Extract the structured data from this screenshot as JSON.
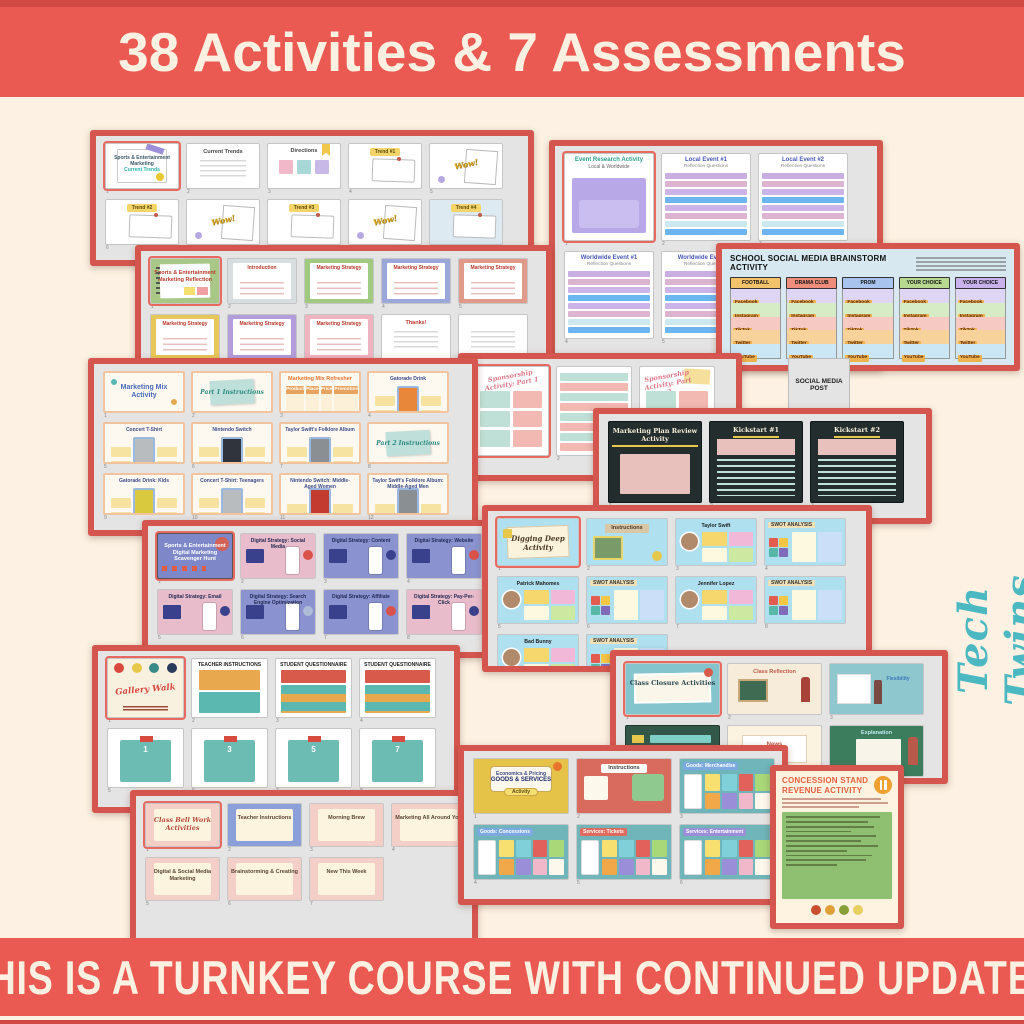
{
  "top_banner": {
    "text": "38 Activities & 7 Assessments",
    "bg": "#ea5a52",
    "fg": "#fbf0e1"
  },
  "bottom_banner": {
    "text": "THIS IS A TURNKEY COURSE WITH CONTINUED UPDATES",
    "bg": "#ea5a52",
    "fg": "#fbf0e1"
  },
  "watermark": {
    "text": "Tech Twins",
    "color": "#4bb8c2"
  },
  "social_media_post_label": "SOCIAL MEDIA POST",
  "colors": {
    "background": "#fcf1e2",
    "panel_border": "#d5564e",
    "panel_bg": "#e4e4e4",
    "banner_edge": "#d04a43"
  },
  "panels": [
    {
      "id": "current-trends",
      "type": "slides",
      "slides": [
        {
          "n": "Sports & Entertainment Marketing",
          "sub": "Current Trends",
          "style": "titlenote",
          "sel": true,
          "chips": [
            "#e8c830"
          ]
        },
        {
          "n": "Current Trends",
          "style": "doc"
        },
        {
          "n": "Directions",
          "style": "stickies",
          "chips": [
            "#f0b8c8",
            "#a8d8d8",
            "#c8b8e8"
          ]
        },
        {
          "n": "Trend #1",
          "style": "trend"
        },
        {
          "n": "Wow!",
          "style": "wow"
        },
        {
          "n": "Trend #2",
          "style": "trend"
        },
        {
          "n": "Wow!",
          "style": "wow"
        },
        {
          "n": "Trend #3",
          "style": "trend"
        },
        {
          "n": "Wow!",
          "style": "wow"
        },
        {
          "n": "Trend #4",
          "style": "trend",
          "bg": "#ddeaf2"
        }
      ]
    },
    {
      "id": "marketing-reflection",
      "type": "slides",
      "slides": [
        {
          "n": "Sports & Entertainment Marketing Reflection",
          "style": "greencover",
          "sel": true,
          "chips": [
            "#f5df70",
            "#f0a0a0"
          ]
        },
        {
          "n": "Introduction",
          "style": "notebook",
          "accent": "#d8dde0"
        },
        {
          "n": "Marketing Strategy",
          "style": "notebook",
          "accent": "#9fca7f"
        },
        {
          "n": "Marketing Strategy",
          "style": "notebook",
          "accent": "#9aa7d8"
        },
        {
          "n": "Marketing Strategy",
          "style": "notebook",
          "accent": "#e09a8a"
        },
        {
          "n": "Marketing Strategy",
          "style": "notebook",
          "accent": "#e8c75a"
        },
        {
          "n": "Marketing Strategy",
          "style": "notebook",
          "accent": "#b39ddb"
        },
        {
          "n": "Marketing Strategy",
          "style": "notebook",
          "accent": "#f0b3c0"
        },
        {
          "n": "Thanks!",
          "style": "doc",
          "lc": "#c0392b",
          "chips": []
        },
        {
          "n": "",
          "style": "doc",
          "chips": []
        }
      ]
    },
    {
      "id": "event-research",
      "type": "slides",
      "slides": [
        {
          "n": "Event Research Activity",
          "sub": "Local & Worldwide",
          "style": "eventcover",
          "sel": true
        },
        {
          "n": "Local Event #1",
          "sub": "Reflection Questions",
          "style": "qsheet",
          "bars": [
            "#c9aee2",
            "#dcb4cf",
            "#cbb4e8",
            "#6db5f0",
            "#cbb4e8",
            "#dcb4cf",
            "#cde9f0",
            "#6db5f0"
          ]
        },
        {
          "n": "Local Event #2",
          "sub": "Reflection Questions",
          "style": "qsheet",
          "bars": [
            "#c9aee2",
            "#dcb4cf",
            "#cbb4e8",
            "#6db5f0",
            "#cbb4e8",
            "#dcb4cf",
            "#cde9f0",
            "#6db5f0"
          ]
        },
        {
          "n": "Worldwide Event #1",
          "sub": "Reflection Questions",
          "style": "qsheet",
          "bars": [
            "#c9aee2",
            "#dcb4cf",
            "#cbb4e8",
            "#6db5f0",
            "#cbb4e8",
            "#dcb4cf",
            "#cde9f0",
            "#6db5f0"
          ]
        },
        {
          "n": "Worldwide Event #2",
          "sub": "Reflection Questions",
          "style": "qsheet",
          "bars": [
            "#c9aee2",
            "#dcb4cf",
            "#cbb4e8",
            "#6db5f0",
            "#cbb4e8",
            "#dcb4cf",
            "#cde9f0",
            "#6db5f0"
          ]
        }
      ]
    },
    {
      "id": "social-media-brainstorm",
      "type": "brainstorm",
      "title": "SCHOOL SOCIAL MEDIA BRAINSTORM ACTIVITY",
      "columns": [
        {
          "label": "FOOTBALL",
          "color": "#f3c36b"
        },
        {
          "label": "DRAMA CLUB",
          "color": "#ee8d7c"
        },
        {
          "label": "PROM",
          "color": "#a9c3ef"
        },
        {
          "label": "YOUR CHOICE",
          "color": "#b6d88f"
        },
        {
          "label": "YOUR CHOICE",
          "color": "#c9b2ec"
        }
      ],
      "rows": [
        "Facebook",
        "Instagram",
        "TikTok",
        "Twitter",
        "YouTube"
      ],
      "row_colors": [
        "#ded6f4",
        "#d6ecc4",
        "#f6c9c2",
        "#f7d29a",
        "#cbe7f6"
      ],
      "chip_color": "#f0b24f"
    },
    {
      "id": "marketing-mix",
      "type": "slides",
      "slides": [
        {
          "n": "Marketing Mix Activity",
          "style": "mixcover"
        },
        {
          "n": "Part 1 Instructions",
          "style": "stickynote"
        },
        {
          "n": "Marketing Mix Refresher",
          "style": "refresher",
          "cols4": [
            "Product",
            "Place",
            "Price",
            "Promotion"
          ]
        },
        {
          "n": "Gatorade Drink",
          "style": "product",
          "accent": "#e8873a",
          "chips": [
            "#f7e3a1",
            "#f7e3a1",
            "#f7e3a1",
            "#f7e3a1"
          ]
        },
        {
          "n": "Concert T-Shirt",
          "style": "product",
          "accent": "#b9bcbe",
          "chips": [
            "#f7e3a1",
            "#f7e3a1",
            "#f7e3a1",
            "#f7e3a1"
          ]
        },
        {
          "n": "Nintendo Switch",
          "style": "product",
          "accent": "#30343c",
          "chips": [
            "#f7e3a1",
            "#f7e3a1",
            "#f7e3a1",
            "#f7e3a1"
          ]
        },
        {
          "n": "Taylor Swift's Folklore Album",
          "style": "product",
          "accent": "#8a8f94",
          "chips": [
            "#f7e3a1",
            "#f7e3a1",
            "#f7e3a1",
            "#f7e3a1"
          ]
        },
        {
          "n": "Part 2 Instructions",
          "style": "stickynote"
        },
        {
          "n": "Gatorade Drink: Kids",
          "style": "product",
          "accent": "#d8c93e",
          "chips": [
            "#f7e3a1",
            "#f7e3a1",
            "#f7e3a1",
            "#f7e3a1"
          ]
        },
        {
          "n": "Concert T-Shirt: Teenagers",
          "style": "product",
          "accent": "#b9bcbe",
          "chips": [
            "#f7e3a1",
            "#f7e3a1",
            "#f7e3a1",
            "#f7e3a1"
          ]
        },
        {
          "n": "Nintendo Switch: Middle-Aged Women",
          "style": "product",
          "accent": "#c23b2e",
          "chips": [
            "#f7e3a1",
            "#f7e3a1",
            "#f7e3a1",
            "#f7e3a1"
          ]
        },
        {
          "n": "Taylor Swift's Folklore Album: Middle-Aged Men",
          "style": "product",
          "accent": "#8a8f94",
          "chips": [
            "#f7e3a1",
            "#f7e3a1",
            "#f7e3a1",
            "#f7e3a1"
          ]
        }
      ]
    },
    {
      "id": "sponsorship",
      "type": "slides",
      "slides": [
        {
          "n": "Sponsorship Activity: Part 1",
          "style": "sponsor",
          "sel": true,
          "chips": [
            "#bfe0d6",
            "#f2b9b2",
            "#bfe0d6",
            "#f2b9b2",
            "#bfe0d6",
            "#f2b9b2"
          ]
        },
        {
          "n": "",
          "style": "companysheet",
          "bars": [
            "#bfe0d6",
            "#f2b9b2",
            "#bfe0d6",
            "#f2b9b2",
            "#bfe0d6",
            "#f2b9b2",
            "#bfe0d6",
            "#f2b9b2"
          ]
        },
        {
          "n": "Sponsorship Activity: Part 2",
          "style": "sponsor2",
          "chips": [
            "#bfe0d6",
            "#f2b9b2"
          ]
        }
      ]
    },
    {
      "id": "marketing-plan-review",
      "type": "slides",
      "slides": [
        {
          "n": "Marketing Plan Review Activity",
          "style": "chalk"
        },
        {
          "n": "Kickstart #1",
          "style": "chalkq"
        },
        {
          "n": "Kickstart #2",
          "style": "chalkq"
        }
      ]
    },
    {
      "id": "digital-scavenger-hunt",
      "type": "slides",
      "slides": [
        {
          "n": "Sports & Entertainment Digital Marketing Scavenger Hunt",
          "style": "scavcover",
          "bg": "#7e88c9",
          "sel": true
        },
        {
          "n": "Digital Strategy: Social Media",
          "style": "phone",
          "bg": "#e9bccb",
          "chips": [
            "#d9534a"
          ]
        },
        {
          "n": "Digital Strategy: Content",
          "style": "phone",
          "bg": "#8a93cf",
          "chips": [
            "#39418c"
          ]
        },
        {
          "n": "Digital Strategy: Website",
          "style": "phone",
          "bg": "#8a93cf",
          "chips": [
            "#d9534a"
          ]
        },
        {
          "n": "Digital Strategy: Email",
          "style": "phone",
          "bg": "#e9bccb",
          "chips": [
            "#39418c"
          ]
        },
        {
          "n": "Digital Strategy: Search Engine Optimization",
          "style": "phone",
          "bg": "#8a93cf",
          "chips": [
            "#aebcd8"
          ]
        },
        {
          "n": "Digital Strategy: Affiliate",
          "style": "phone",
          "bg": "#8a93cf",
          "chips": [
            "#d9534a"
          ]
        },
        {
          "n": "Digital Strategy: Pay-Per-Click",
          "style": "phone",
          "bg": "#e9bccb",
          "chips": [
            "#39418c"
          ]
        }
      ]
    },
    {
      "id": "digging-deep",
      "type": "slides",
      "slides": [
        {
          "n": "Digging Deep Activity",
          "style": "digcover",
          "bg": "#aee0f0",
          "sel": true
        },
        {
          "n": "Instructions",
          "style": "diginstr",
          "bg": "#aee0f0"
        },
        {
          "n": "Taylor Swift",
          "style": "person",
          "bg": "#aee0f0",
          "chips": [
            "#f5d76e",
            "#f2b8d8",
            "#fdf8e0",
            "#cde8a0"
          ]
        },
        {
          "n": "SWOT ANALYSIS",
          "style": "swot",
          "bg": "#aee0f0",
          "chips": [
            "#e45b4f",
            "#f5c544",
            "#58b8a8",
            "#7f6bb8"
          ]
        },
        {
          "n": "Patrick Mahomes",
          "style": "person",
          "bg": "#aee0f0",
          "chips": [
            "#f5d76e",
            "#f2b8d8",
            "#fdf8e0",
            "#cde8a0"
          ]
        },
        {
          "n": "SWOT ANALYSIS",
          "style": "swot",
          "bg": "#aee0f0",
          "chips": [
            "#e45b4f",
            "#f5c544",
            "#58b8a8",
            "#7f6bb8"
          ]
        },
        {
          "n": "Jennifer Lopez",
          "style": "person",
          "bg": "#aee0f0",
          "chips": [
            "#f5d76e",
            "#f2b8d8",
            "#fdf8e0",
            "#cde8a0"
          ]
        },
        {
          "n": "SWOT ANALYSIS",
          "style": "swot",
          "bg": "#aee0f0",
          "chips": [
            "#e45b4f",
            "#f5c544",
            "#58b8a8",
            "#7f6bb8"
          ]
        },
        {
          "n": "Bad Bunny",
          "style": "person",
          "bg": "#aee0f0",
          "chips": [
            "#f5d76e",
            "#f2b8d8",
            "#fdf8e0",
            "#cde8a0"
          ]
        },
        {
          "n": "SWOT ANALYSIS",
          "style": "swot",
          "bg": "#aee0f0",
          "chips": [
            "#e45b4f",
            "#f5c544",
            "#58b8a8",
            "#7f6bb8"
          ]
        }
      ]
    },
    {
      "id": "gallery-walk",
      "type": "slides",
      "slides": [
        {
          "n": "Gallery Walk",
          "style": "gallerycover",
          "sel": true,
          "chips": [
            "#d84a3f",
            "#e8c84a",
            "#3a8a8a",
            "#2a3a5a"
          ]
        },
        {
          "n": "TEACHER INSTRUCTIONS",
          "style": "gwteacher"
        },
        {
          "n": "STUDENT QUESTIONNAIRE",
          "style": "gwstudent"
        },
        {
          "n": "STUDENT QUESTIONNAIRE",
          "style": "gwstudent"
        },
        {
          "n": "1",
          "style": "gwcard",
          "accent": "#6cbcb4"
        },
        {
          "n": "3",
          "style": "gwcard",
          "accent": "#6cbcb4"
        },
        {
          "n": "5",
          "style": "gwcard",
          "accent": "#6cbcb4"
        },
        {
          "n": "7",
          "style": "gwcard",
          "accent": "#6cbcb4"
        }
      ]
    },
    {
      "id": "class-closure",
      "type": "slides",
      "slides": [
        {
          "n": "Class Closure Activities",
          "style": "closurecover",
          "sel": true
        },
        {
          "n": "Class Reflection",
          "style": "teachslide",
          "bg": "#f7ecd9"
        },
        {
          "n": "Flexibility",
          "style": "teachslide2",
          "bg": "#8fc7cf"
        },
        {
          "n": "",
          "style": "chalkgreen",
          "chips": [
            "#7fd0c8",
            "#7fd0c8",
            "#7fd0c8",
            "#7fd0c8"
          ]
        },
        {
          "n": "News",
          "style": "newsslide",
          "bg": "#fbf2df",
          "chips": [
            "#d84a3f",
            "#3a8a6a",
            "#e8c84a",
            "#7a9a3a"
          ]
        },
        {
          "n": "Explanation",
          "style": "explain",
          "bg": "#3c7d5e"
        }
      ]
    },
    {
      "id": "bell-work",
      "type": "slides",
      "slides": [
        {
          "n": "Class Bell Work Activities",
          "style": "bellcover",
          "sel": true
        },
        {
          "n": "Teacher Instructions",
          "style": "bellblue"
        },
        {
          "n": "Morning Brew",
          "style": "bell"
        },
        {
          "n": "Marketing All Around You",
          "style": "bell"
        },
        {
          "n": "Digital & Social Media Marketing",
          "style": "bell"
        },
        {
          "n": "Brainstorming & Creating",
          "style": "bell"
        },
        {
          "n": "New This Week",
          "style": "bell"
        }
      ]
    },
    {
      "id": "goods-services",
      "type": "slides",
      "slides": [
        {
          "n": "Economics & Pricing",
          "sub": "GOODS & SERVICES",
          "badge": "Activity",
          "style": "econcover"
        },
        {
          "n": "Instructions",
          "style": "econinstr",
          "bg": "#d96a5e"
        },
        {
          "n": "Goods: Merchandise",
          "style": "stickygrid",
          "accent": "#7ba9e0",
          "chips": [
            "#f7df70",
            "#7fd0d8",
            "#e2615a",
            "#a8d878",
            "#f0a848",
            "#9b8ed8",
            "#f0b8c8",
            "#fdf8ec"
          ]
        },
        {
          "n": "Goods: Concessions",
          "style": "stickygrid",
          "accent": "#7ba9e0",
          "chips": [
            "#f7df70",
            "#7fd0d8",
            "#e2615a",
            "#a8d878",
            "#f0a848",
            "#9b8ed8",
            "#f0b8c8",
            "#fdf8ec"
          ]
        },
        {
          "n": "Services: Tickets",
          "style": "stickygrid",
          "accent": "#e06a5e",
          "chips": [
            "#f7df70",
            "#7fd0d8",
            "#e2615a",
            "#a8d878",
            "#f0a848",
            "#9b8ed8",
            "#f0b8c8",
            "#fdf8ec"
          ]
        },
        {
          "n": "Services: Entertainment",
          "style": "stickygrid",
          "accent": "#9b8ed8",
          "chips": [
            "#f7df70",
            "#7fd0d8",
            "#e2615a",
            "#a8d878",
            "#f0a848",
            "#9b8ed8",
            "#f0b8c8",
            "#fdf8ec"
          ]
        }
      ]
    },
    {
      "id": "concession-stand",
      "type": "poster",
      "title_line1": "CONCESSION STAND",
      "title_line2": "REVENUE ACTIVITY",
      "icon": "fork-and-knife",
      "colors": {
        "title": "#e2603f",
        "body": "#8fbf70",
        "page": "#fdf3e0",
        "icon_bg": "#f0a030"
      },
      "food_colors": [
        "#c8502e",
        "#e0a03a",
        "#88a03a",
        "#e8d060"
      ]
    }
  ]
}
